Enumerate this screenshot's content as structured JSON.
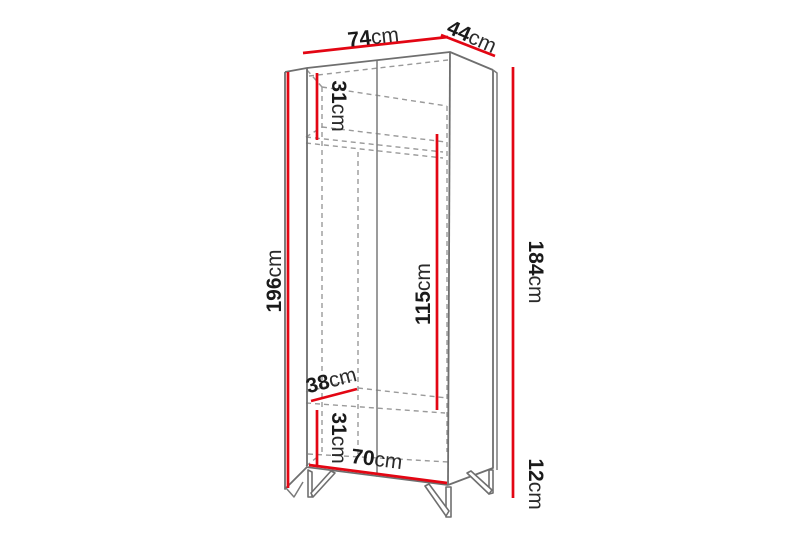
{
  "diagram": {
    "title": "wardrobe-dimension-diagram",
    "unit": "cm",
    "colors": {
      "dimension_line": "#e30613",
      "outline": "#6f6f6f",
      "hidden_line": "#9a9a9a",
      "label_text": "#1a1a1a",
      "background": "#ffffff"
    },
    "dimensions": [
      {
        "id": "top-width",
        "value": "74",
        "unit": "cm"
      },
      {
        "id": "top-depth",
        "value": "44",
        "unit": "cm"
      },
      {
        "id": "upper-section-height",
        "value": "31",
        "unit": "cm"
      },
      {
        "id": "total-height",
        "value": "196",
        "unit": "cm"
      },
      {
        "id": "interior-height",
        "value": "115",
        "unit": "cm"
      },
      {
        "id": "body-height",
        "value": "184",
        "unit": "cm"
      },
      {
        "id": "shelf-depth",
        "value": "38",
        "unit": "cm"
      },
      {
        "id": "lower-section-height",
        "value": "31",
        "unit": "cm"
      },
      {
        "id": "interior-width",
        "value": "70",
        "unit": "cm"
      },
      {
        "id": "leg-height",
        "value": "12",
        "unit": "cm"
      }
    ]
  }
}
